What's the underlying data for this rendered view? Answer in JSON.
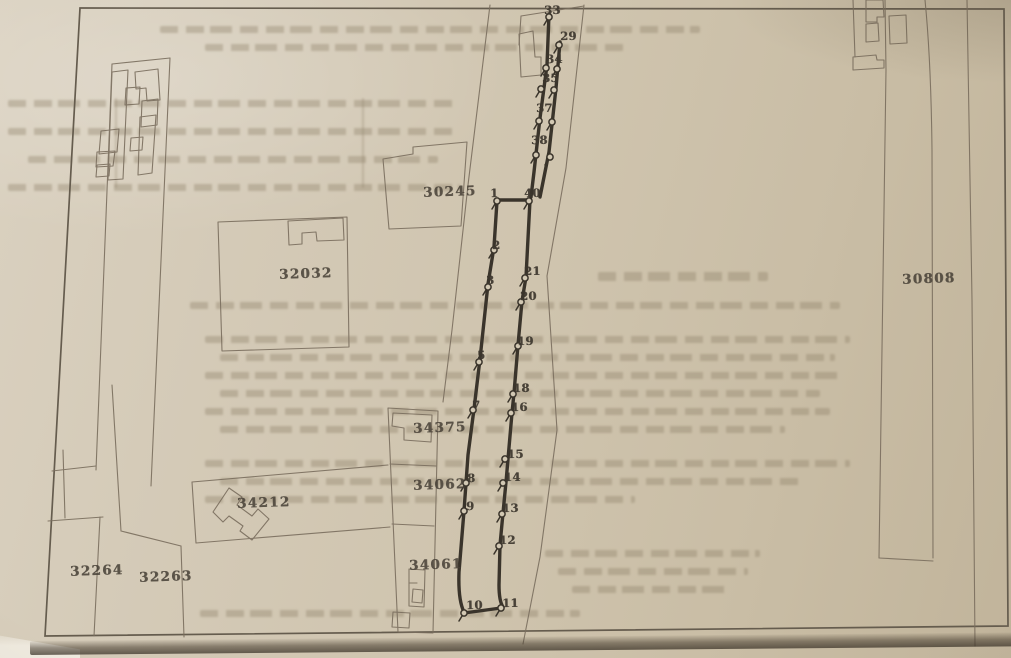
{
  "map": {
    "description": "Scanned cadastral site plan with numbered survey route",
    "colors": {
      "paper": "#d2c8b3",
      "ink": "#4a4339",
      "bold_route": "#3a342b",
      "thin_line": "#7a6e5e"
    }
  },
  "parcels": [
    {
      "id": "30245"
    },
    {
      "id": "32032"
    },
    {
      "id": "30808"
    },
    {
      "id": "34375"
    },
    {
      "id": "34062"
    },
    {
      "id": "34212"
    },
    {
      "id": "32264"
    },
    {
      "id": "32263"
    },
    {
      "id": "34061"
    }
  ],
  "route_points": [
    {
      "label": "33"
    },
    {
      "label": "29"
    },
    {
      "label": "34"
    },
    {
      "label": "35"
    },
    {
      "label": "37"
    },
    {
      "label": "38"
    },
    {
      "label": "1"
    },
    {
      "label": "40"
    },
    {
      "label": "2"
    },
    {
      "label": "3"
    },
    {
      "label": "5"
    },
    {
      "label": "7"
    },
    {
      "label": "8"
    },
    {
      "label": "9"
    },
    {
      "label": "10"
    },
    {
      "label": "21"
    },
    {
      "label": "20"
    },
    {
      "label": "19"
    },
    {
      "label": "18"
    },
    {
      "label": "16"
    },
    {
      "label": "15"
    },
    {
      "label": "14"
    },
    {
      "label": "13"
    },
    {
      "label": "12"
    },
    {
      "label": "11"
    }
  ]
}
